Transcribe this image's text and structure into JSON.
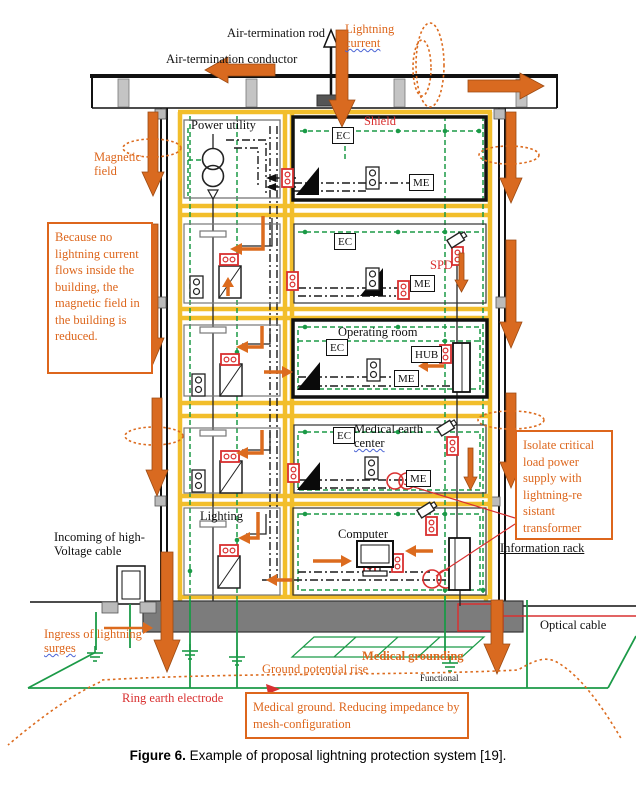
{
  "caption": {
    "bold": "Figure 6.",
    "text": " Example of proposal lightning protection system [19]."
  },
  "top": {
    "air_rod": "Air-termination rod",
    "air_conductor": "Air-termination conductor",
    "lightning_1": "Lightning",
    "lightning_2": "current"
  },
  "left": {
    "magnetic_1": "Magnetic",
    "magnetic_2": "field",
    "reduced_box": "Because no lightning current flows inside the building, the magnetic field in the building is reduced.",
    "incoming": "Incoming of high-Voltage cable",
    "ingress_1": "Ingress of lightning",
    "ingress_2": "surges"
  },
  "right": {
    "isolate_box": "Isolate critical load power supply with lightning-re sistant transformer",
    "information_rack": "Information rack",
    "optical_cable": "Optical cable"
  },
  "rooms": {
    "power_utility": "Power utility",
    "shield": "Shield",
    "operating": "Operating room",
    "medical_center_1": "Medical earth",
    "medical_center_2": "center",
    "lighting": "Lighting",
    "computer": "Computer"
  },
  "devices": {
    "ec": "EC",
    "me": "ME",
    "hub": "HUB",
    "spd": "SPD"
  },
  "ground": {
    "potential_rise": "Ground potential rise",
    "medical_grounding": "Medical grounding",
    "functional": "Functional",
    "ring_earth": "Ring earth electrode",
    "medical_ground_box": "Medical ground. Reducing impedance by mesh-configuration"
  },
  "colors": {
    "orange": "#DD661C",
    "yellow": "#F2BE2B",
    "green": "#1B9A47",
    "red": "#D93030",
    "gray": "#7C7C7C"
  }
}
